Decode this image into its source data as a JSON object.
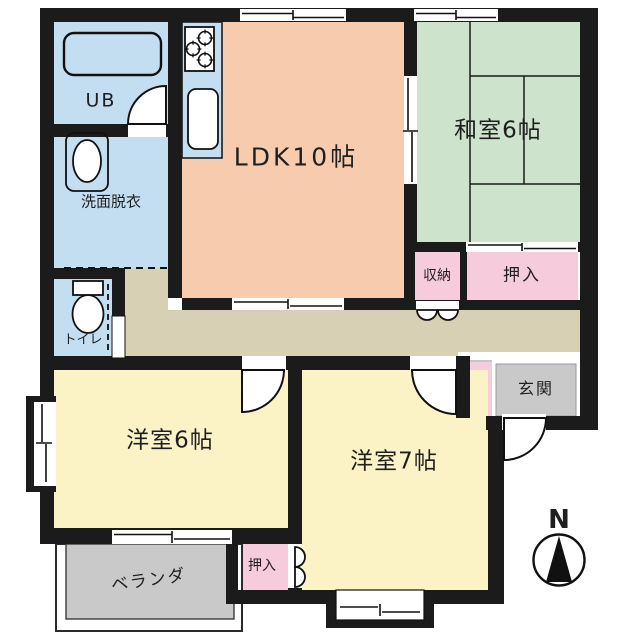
{
  "plan_title": "apartment floor plan",
  "colors": {
    "wall": "#1b1b1b",
    "water": "#c3ddf1",
    "ldk": "#f6cbae",
    "tatami": "#cde3cb",
    "closet": "#f6cbdb",
    "bedroom": "#fbf3c6",
    "hallway": "#d8d0b5",
    "concrete": "#c9c9c9",
    "text": "#1f1f1f"
  },
  "labels": {
    "ldk": "LDK10帖",
    "washitsu": "和室6帖",
    "ub": "UB",
    "senmen": "洗面脱衣",
    "toilet": "トイレ",
    "shuno": "収納",
    "oshiire_top": "押入",
    "genkan": "玄関",
    "yoshitsu6": "洋室6帖",
    "yoshitsu7": "洋室7帖",
    "oshiire_bottom": "押入",
    "veranda": "ベランダ"
  },
  "compass": {
    "north": "N"
  }
}
